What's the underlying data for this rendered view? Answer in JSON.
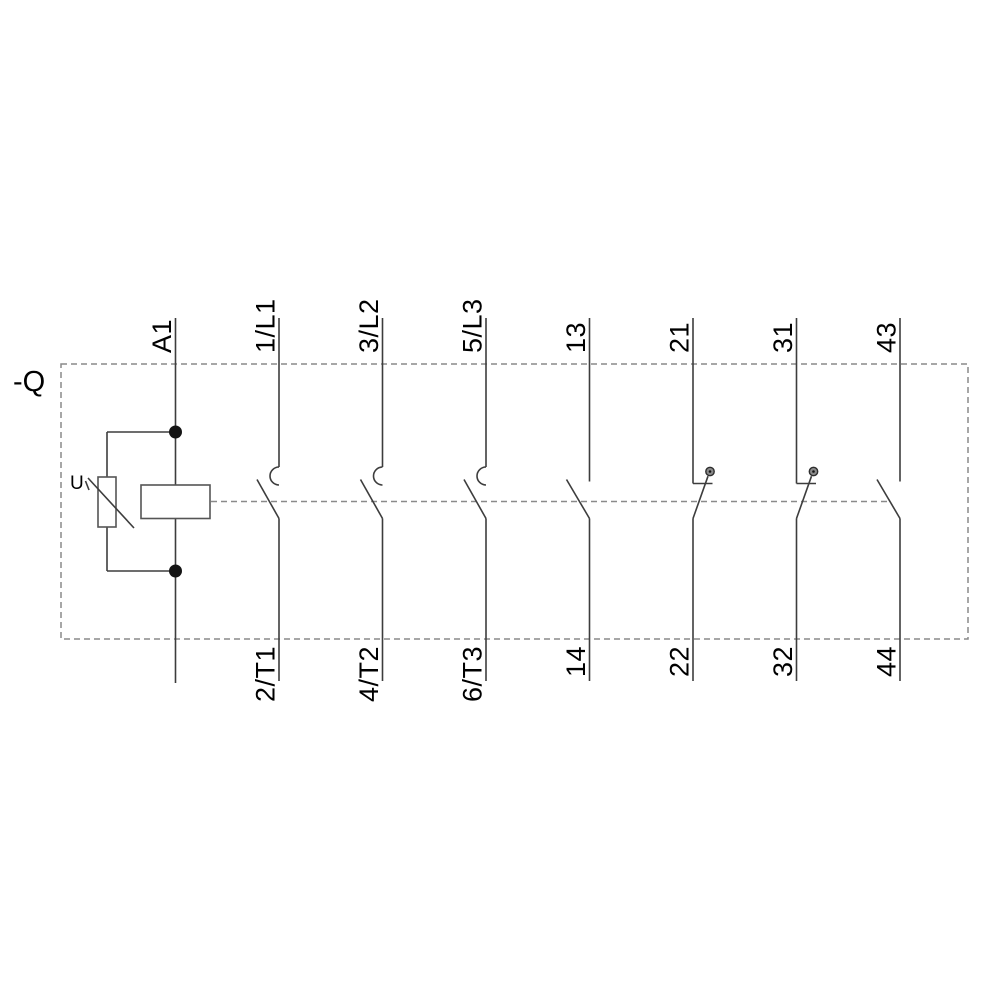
{
  "device_label": "-Q",
  "varistor_label": "U",
  "coil": {
    "top_terminal": "A1"
  },
  "main_contacts": [
    {
      "top": "1/L1",
      "bottom": "2/T1"
    },
    {
      "top": "3/L2",
      "bottom": "4/T2"
    },
    {
      "top": "5/L3",
      "bottom": "6/T3"
    }
  ],
  "aux_contacts": [
    {
      "top": "13",
      "bottom": "14",
      "type": "NO"
    },
    {
      "top": "21",
      "bottom": "22",
      "type": "NC"
    },
    {
      "top": "31",
      "bottom": "32",
      "type": "NC"
    },
    {
      "top": "43",
      "bottom": "44",
      "type": "NO"
    }
  ],
  "colors": {
    "line": "#3d3d3d",
    "dashed_boundary": "#8a8a8a",
    "text": "#000000",
    "background": "#ffffff"
  }
}
